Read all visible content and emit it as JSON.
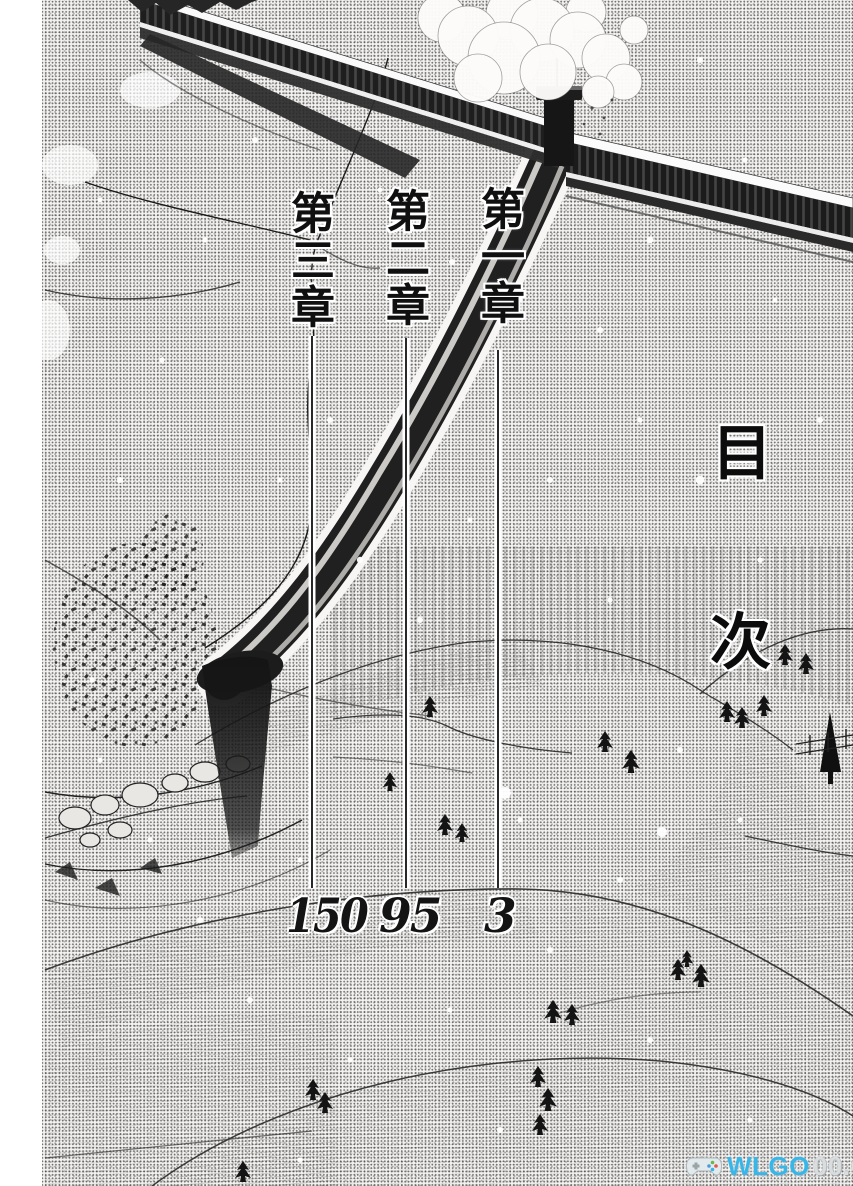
{
  "page": {
    "toc_title": {
      "char_1": "目",
      "char_2": "次"
    },
    "entries": [
      {
        "chapter": "第一章",
        "page_number": "3"
      },
      {
        "chapter": "第二章",
        "page_number": "95"
      },
      {
        "chapter": "第三章",
        "page_number": "150"
      }
    ]
  },
  "watermark": {
    "primary": "WLGO",
    "secondary": "00.COM",
    "icon": "gamepad-icon",
    "colors": {
      "primary": "#38b6e8",
      "secondary": "#d9dde0"
    }
  },
  "artwork": {
    "style": "black-and-white manga halftone",
    "description": "Snow-covered gorge with a railway trestle bridge crossing at top, a smoking chimney at the junction, a timber chute descending to the valley floor, rocky cliffs at left and snowy hills with scattered pines below"
  }
}
